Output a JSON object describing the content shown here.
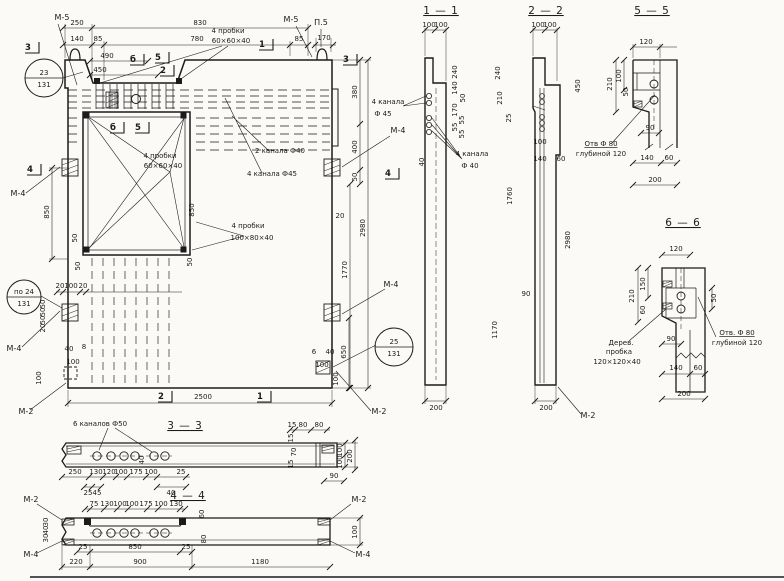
{
  "drawing": {
    "kind": "concrete wall panel shop drawing",
    "overall_dims": {
      "width": "2500",
      "height": "2980"
    }
  },
  "section_titles": [
    {
      "t": "1 — 1",
      "x": 441,
      "y": 14
    },
    {
      "t": "2 — 2",
      "x": 546,
      "y": 14
    },
    {
      "t": "5 — 5",
      "x": 652,
      "y": 14
    },
    {
      "t": "6 — 6",
      "x": 683,
      "y": 226
    },
    {
      "t": "3 — 3",
      "x": 185,
      "y": 429
    },
    {
      "t": "4 — 4",
      "x": 188,
      "y": 499
    }
  ],
  "marks": [
    {
      "t": "М-5",
      "x": 62,
      "y": 20
    },
    {
      "t": "М-5",
      "x": 291,
      "y": 22
    },
    {
      "t": "П.5",
      "x": 321,
      "y": 25
    },
    {
      "t": "М-4",
      "x": 18,
      "y": 196
    },
    {
      "t": "М-4",
      "x": 14,
      "y": 351
    },
    {
      "t": "М-2",
      "x": 26,
      "y": 414
    },
    {
      "t": "М-4",
      "x": 398,
      "y": 133
    },
    {
      "t": "М-4",
      "x": 391,
      "y": 287
    },
    {
      "t": "М-2",
      "x": 379,
      "y": 414
    },
    {
      "t": "М-2",
      "x": 588,
      "y": 418
    },
    {
      "t": "М-2",
      "x": 31,
      "y": 502
    },
    {
      "t": "М-2",
      "x": 359,
      "y": 502
    },
    {
      "t": "М-4",
      "x": 31,
      "y": 557
    },
    {
      "t": "М-4",
      "x": 363,
      "y": 557
    }
  ],
  "markers": [
    {
      "t": "3",
      "x": 28,
      "y": 50
    },
    {
      "t": "б",
      "x": 133,
      "y": 62
    },
    {
      "t": "5",
      "x": 158,
      "y": 60
    },
    {
      "t": "2",
      "x": 163,
      "y": 73
    },
    {
      "t": "1",
      "x": 262,
      "y": 47
    },
    {
      "t": "3",
      "x": 346,
      "y": 62
    },
    {
      "t": "4",
      "x": 30,
      "y": 172
    },
    {
      "t": "4",
      "x": 388,
      "y": 176
    },
    {
      "t": "б",
      "x": 113,
      "y": 130
    },
    {
      "t": "5",
      "x": 138,
      "y": 130
    },
    {
      "t": "2",
      "x": 161,
      "y": 399
    },
    {
      "t": "1",
      "x": 260,
      "y": 399
    }
  ],
  "ref_circles": [
    {
      "top": "23",
      "bottom": "131",
      "x": 44,
      "y": 78,
      "r": 19
    },
    {
      "top": "по 24",
      "bottom": "131",
      "x": 24,
      "y": 297,
      "r": 17
    },
    {
      "top": "25",
      "bottom": "131",
      "x": 394,
      "y": 347,
      "r": 19
    }
  ],
  "notes": [
    {
      "t": "4 пробки",
      "x": 228,
      "y": 33
    },
    {
      "t": "60×60×40",
      "x": 231,
      "y": 43
    },
    {
      "t": "4 пробки",
      "x": 160,
      "y": 158
    },
    {
      "t": "60×60×40",
      "x": 163,
      "y": 168
    },
    {
      "t": "4 пробки",
      "x": 248,
      "y": 228
    },
    {
      "t": "100×80×40",
      "x": 252,
      "y": 240
    },
    {
      "t": "2 канала Ф40",
      "x": 280,
      "y": 153
    },
    {
      "t": "4 канала Ф45",
      "x": 272,
      "y": 176
    },
    {
      "t": "4 канала",
      "x": 388,
      "y": 104
    },
    {
      "t": "Ф 45",
      "x": 383,
      "y": 116
    },
    {
      "t": "4 канала",
      "x": 472,
      "y": 156
    },
    {
      "t": "Ф 40",
      "x": 470,
      "y": 168
    },
    {
      "t": "6 каналов Ф50",
      "x": 100,
      "y": 426
    },
    {
      "t": "Отв Ф 80",
      "x": 601,
      "y": 146,
      "ul": true
    },
    {
      "t": "глубиной 120",
      "x": 601,
      "y": 156
    },
    {
      "t": "Дерев.",
      "x": 621,
      "y": 345
    },
    {
      "t": "пробка",
      "x": 619,
      "y": 354
    },
    {
      "t": "120×120×40",
      "x": 617,
      "y": 364
    },
    {
      "t": "Отв. Ф 80",
      "x": 737,
      "y": 335,
      "ul": true
    },
    {
      "t": "глубиной 120",
      "x": 737,
      "y": 345
    }
  ],
  "dims": [
    {
      "t": "250",
      "x": 77,
      "y": 25
    },
    {
      "t": "830",
      "x": 200,
      "y": 25
    },
    {
      "t": "140",
      "x": 77,
      "y": 41
    },
    {
      "t": "85",
      "x": 98,
      "y": 41
    },
    {
      "t": "780",
      "x": 197,
      "y": 41
    },
    {
      "t": "85",
      "x": 299,
      "y": 41
    },
    {
      "t": "490",
      "x": 107,
      "y": 58
    },
    {
      "t": "450",
      "x": 100,
      "y": 72
    },
    {
      "t": "170",
      "x": 324,
      "y": 40
    },
    {
      "t": "380",
      "x": 357,
      "y": 92,
      "v": 1
    },
    {
      "t": "400",
      "x": 357,
      "y": 147,
      "v": 1
    },
    {
      "t": "50",
      "x": 357,
      "y": 177,
      "v": 1
    },
    {
      "t": "2980",
      "x": 365,
      "y": 228,
      "v": 1
    },
    {
      "t": "1770",
      "x": 347,
      "y": 270,
      "v": 1
    },
    {
      "t": "20",
      "x": 340,
      "y": 218
    },
    {
      "t": "850",
      "x": 49,
      "y": 212,
      "v": 1
    },
    {
      "t": "50",
      "x": 77,
      "y": 238,
      "v": 1
    },
    {
      "t": "50",
      "x": 80,
      "y": 266,
      "v": 1
    },
    {
      "t": "20",
      "x": 60,
      "y": 288
    },
    {
      "t": "100",
      "x": 71,
      "y": 288
    },
    {
      "t": "20",
      "x": 83,
      "y": 288
    },
    {
      "t": "50",
      "x": 45,
      "y": 304,
      "v": 1
    },
    {
      "t": "50",
      "x": 45,
      "y": 312,
      "v": 1
    },
    {
      "t": "50",
      "x": 45,
      "y": 320,
      "v": 1
    },
    {
      "t": "20",
      "x": 45,
      "y": 328,
      "v": 1
    },
    {
      "t": "40",
      "x": 69,
      "y": 351
    },
    {
      "t": "8",
      "x": 84,
      "y": 349
    },
    {
      "t": "100",
      "x": 73,
      "y": 364
    },
    {
      "t": "100",
      "x": 41,
      "y": 378,
      "v": 1
    },
    {
      "t": "850",
      "x": 194,
      "y": 210,
      "v": 1
    },
    {
      "t": "50",
      "x": 192,
      "y": 262,
      "v": 1
    },
    {
      "t": "2500",
      "x": 203,
      "y": 399
    },
    {
      "t": "6",
      "x": 314,
      "y": 354
    },
    {
      "t": "40",
      "x": 330,
      "y": 354
    },
    {
      "t": "100",
      "x": 322,
      "y": 367
    },
    {
      "t": "100",
      "x": 338,
      "y": 379,
      "v": 1
    },
    {
      "t": "650",
      "x": 346,
      "y": 352,
      "v": 1
    },
    {
      "t": "100",
      "x": 429,
      "y": 27
    },
    {
      "t": "100",
      "x": 441,
      "y": 27
    },
    {
      "t": "240",
      "x": 457,
      "y": 72,
      "v": 1
    },
    {
      "t": "140",
      "x": 457,
      "y": 88,
      "v": 1
    },
    {
      "t": "50",
      "x": 465,
      "y": 98,
      "v": 1
    },
    {
      "t": "170",
      "x": 457,
      "y": 110,
      "v": 1
    },
    {
      "t": "55",
      "x": 464,
      "y": 120,
      "v": 1
    },
    {
      "t": "55",
      "x": 457,
      "y": 127,
      "v": 1
    },
    {
      "t": "55",
      "x": 464,
      "y": 134,
      "v": 1
    },
    {
      "t": "40",
      "x": 424,
      "y": 162,
      "v": 1
    },
    {
      "t": "200",
      "x": 436,
      "y": 410
    },
    {
      "t": "100",
      "x": 538,
      "y": 27
    },
    {
      "t": "100",
      "x": 550,
      "y": 27
    },
    {
      "t": "240",
      "x": 500,
      "y": 73,
      "v": 1
    },
    {
      "t": "210",
      "x": 502,
      "y": 98,
      "v": 1
    },
    {
      "t": "25",
      "x": 511,
      "y": 118,
      "v": 1
    },
    {
      "t": "450",
      "x": 580,
      "y": 86,
      "v": 1
    },
    {
      "t": "1760",
      "x": 512,
      "y": 196,
      "v": 1
    },
    {
      "t": "100",
      "x": 540,
      "y": 144
    },
    {
      "t": "140",
      "x": 540,
      "y": 161
    },
    {
      "t": "60",
      "x": 561,
      "y": 161
    },
    {
      "t": "90",
      "x": 526,
      "y": 296
    },
    {
      "t": "1170",
      "x": 497,
      "y": 330,
      "v": 1
    },
    {
      "t": "2980",
      "x": 570,
      "y": 240,
      "v": 1
    },
    {
      "t": "200",
      "x": 546,
      "y": 410
    },
    {
      "t": "120",
      "x": 646,
      "y": 44
    },
    {
      "t": "100",
      "x": 621,
      "y": 76,
      "v": 1
    },
    {
      "t": "50",
      "x": 628,
      "y": 92,
      "v": 1
    },
    {
      "t": "210",
      "x": 612,
      "y": 84,
      "v": 1
    },
    {
      "t": "90",
      "x": 650,
      "y": 130
    },
    {
      "t": "140",
      "x": 647,
      "y": 160
    },
    {
      "t": "60",
      "x": 669,
      "y": 160
    },
    {
      "t": "200",
      "x": 655,
      "y": 182
    },
    {
      "t": "120",
      "x": 676,
      "y": 251
    },
    {
      "t": "150",
      "x": 645,
      "y": 284,
      "v": 1
    },
    {
      "t": "210",
      "x": 634,
      "y": 296,
      "v": 1
    },
    {
      "t": "60",
      "x": 645,
      "y": 310,
      "v": 1
    },
    {
      "t": "50",
      "x": 716,
      "y": 298,
      "v": 1
    },
    {
      "t": "90",
      "x": 671,
      "y": 341
    },
    {
      "t": "140",
      "x": 676,
      "y": 370
    },
    {
      "t": "60",
      "x": 698,
      "y": 370
    },
    {
      "t": "200",
      "x": 684,
      "y": 396
    },
    {
      "t": "250",
      "x": 75,
      "y": 474
    },
    {
      "t": "130",
      "x": 96,
      "y": 474
    },
    {
      "t": "120",
      "x": 109,
      "y": 474
    },
    {
      "t": "100",
      "x": 121,
      "y": 474
    },
    {
      "t": "175",
      "x": 136,
      "y": 474
    },
    {
      "t": "100",
      "x": 151,
      "y": 474
    },
    {
      "t": "25",
      "x": 181,
      "y": 474
    },
    {
      "t": "25",
      "x": 88,
      "y": 495
    },
    {
      "t": "45",
      "x": 97,
      "y": 495
    },
    {
      "t": "40",
      "x": 171,
      "y": 495
    },
    {
      "t": "40",
      "x": 144,
      "y": 460,
      "v": 1
    },
    {
      "t": "15",
      "x": 292,
      "y": 427
    },
    {
      "t": "80",
      "x": 303,
      "y": 427
    },
    {
      "t": "80",
      "x": 319,
      "y": 427
    },
    {
      "t": "15",
      "x": 293,
      "y": 438,
      "v": 1
    },
    {
      "t": "70",
      "x": 296,
      "y": 452,
      "v": 1
    },
    {
      "t": "15",
      "x": 293,
      "y": 464,
      "v": 1
    },
    {
      "t": "100",
      "x": 342,
      "y": 450,
      "v": 1
    },
    {
      "t": "100",
      "x": 342,
      "y": 462,
      "v": 1
    },
    {
      "t": "200",
      "x": 352,
      "y": 456,
      "v": 1
    },
    {
      "t": "90",
      "x": 334,
      "y": 478
    },
    {
      "t": "75",
      "x": 94,
      "y": 506
    },
    {
      "t": "130",
      "x": 107,
      "y": 506
    },
    {
      "t": "100",
      "x": 120,
      "y": 506
    },
    {
      "t": "100",
      "x": 132,
      "y": 506
    },
    {
      "t": "175",
      "x": 146,
      "y": 506
    },
    {
      "t": "100",
      "x": 161,
      "y": 506
    },
    {
      "t": "130",
      "x": 176,
      "y": 506
    },
    {
      "t": "60",
      "x": 204,
      "y": 514,
      "v": 1
    },
    {
      "t": "80",
      "x": 206,
      "y": 539,
      "v": 1
    },
    {
      "t": "25",
      "x": 83,
      "y": 549
    },
    {
      "t": "850",
      "x": 135,
      "y": 549
    },
    {
      "t": "25",
      "x": 186,
      "y": 549
    },
    {
      "t": "220",
      "x": 76,
      "y": 564
    },
    {
      "t": "900",
      "x": 140,
      "y": 564
    },
    {
      "t": "1180",
      "x": 260,
      "y": 564
    },
    {
      "t": "100",
      "x": 357,
      "y": 532,
      "v": 1
    },
    {
      "t": "30",
      "x": 48,
      "y": 522,
      "v": 1
    },
    {
      "t": "40",
      "x": 48,
      "y": 530,
      "v": 1
    },
    {
      "t": "30",
      "x": 48,
      "y": 538,
      "v": 1
    }
  ]
}
